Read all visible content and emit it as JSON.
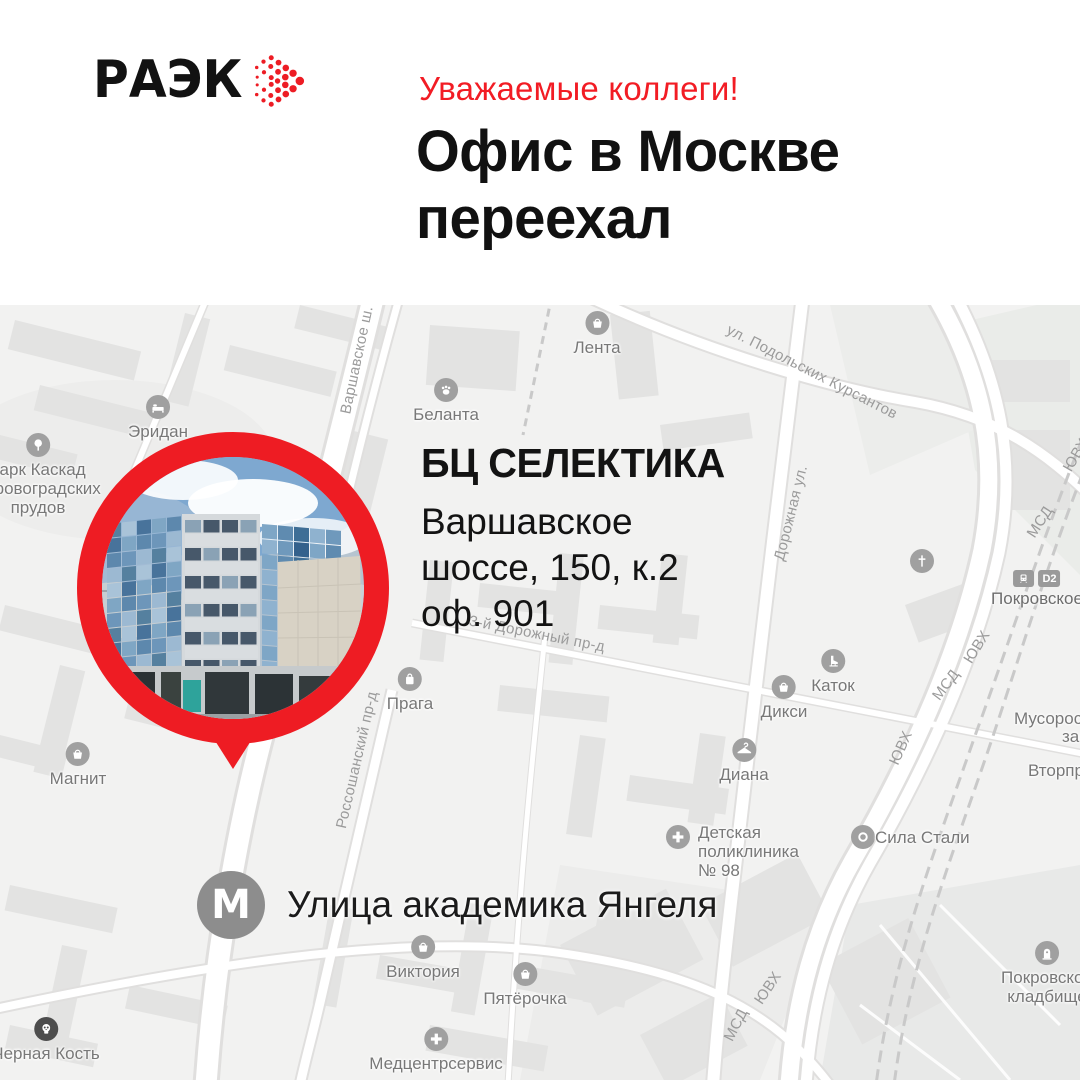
{
  "header": {
    "logo": "РАЭК",
    "greeting": "Уважаемые коллеги!",
    "title_line1": "Офис в Москве",
    "title_line2": "переехал"
  },
  "callout": {
    "name": "БЦ СЕЛЕКТИКА",
    "address_lines": [
      "Варшавское",
      "шоссе, 150, к.2",
      "оф. 901"
    ]
  },
  "metro": {
    "symbol": "М",
    "station": "Улица академика Янгеля"
  },
  "map": {
    "pois": [
      {
        "name": "lenta",
        "icon": "basket",
        "layout": "below",
        "x": 597,
        "y": 6,
        "lines": [
          "Лента"
        ]
      },
      {
        "name": "belanta",
        "icon": "paw",
        "layout": "below",
        "x": 446,
        "y": 73,
        "lines": [
          "Беланта"
        ]
      },
      {
        "name": "eridan",
        "icon": "bed",
        "layout": "below",
        "x": 158,
        "y": 90,
        "lines": [
          "Эридан"
        ]
      },
      {
        "name": "park-kaskad",
        "icon": "tree",
        "layout": "below",
        "x": 38,
        "y": 128,
        "lines": [
          "парк Каскад",
          "Кировоградских",
          "прудов"
        ]
      },
      {
        "name": "magnit",
        "icon": "basket",
        "layout": "below",
        "x": 78,
        "y": 437,
        "lines": [
          "Магнит"
        ]
      },
      {
        "name": "praga",
        "icon": "bag",
        "layout": "below",
        "x": 410,
        "y": 362,
        "lines": [
          "Прага"
        ]
      },
      {
        "name": "katok",
        "icon": "skate",
        "layout": "below",
        "x": 833,
        "y": 344,
        "lines": [
          "Каток"
        ]
      },
      {
        "name": "diksi",
        "icon": "basket",
        "layout": "below",
        "x": 784,
        "y": 370,
        "lines": [
          "Дикси"
        ]
      },
      {
        "name": "diana",
        "icon": "hanger",
        "layout": "below",
        "x": 744,
        "y": 433,
        "lines": [
          "Диана"
        ]
      },
      {
        "name": "detskaya-poliklinika",
        "icon": "med",
        "layout": "left-icon",
        "x": 666,
        "y": 518,
        "lines": [
          "Детская",
          "поликлиника",
          "№ 98"
        ]
      },
      {
        "name": "sila-stali",
        "icon": "ring",
        "layout": "right-icon",
        "x": 843,
        "y": 520,
        "lines": [
          "Сила Стали"
        ]
      },
      {
        "name": "chernaya-kost",
        "icon": "skull",
        "dark": true,
        "layout": "below",
        "x": 46,
        "y": 712,
        "lines": [
          "Черная Кость"
        ]
      },
      {
        "name": "viktoriya",
        "icon": "basket",
        "layout": "below",
        "x": 423,
        "y": 630,
        "lines": [
          "Виктория"
        ]
      },
      {
        "name": "pyaterochka",
        "icon": "basket",
        "layout": "below",
        "x": 525,
        "y": 657,
        "lines": [
          "Пятёрочка"
        ]
      },
      {
        "name": "medcentrservis",
        "icon": "med",
        "layout": "below",
        "x": 436,
        "y": 722,
        "lines": [
          "Медцентрсервис"
        ]
      },
      {
        "name": "pokrovskoe-kladbishche",
        "icon": "tomb",
        "layout": "below",
        "x": 1047,
        "y": 636,
        "lines": [
          "Покровское",
          "кладбище"
        ]
      },
      {
        "name": "church",
        "icon": "cross",
        "layout": "icon-only",
        "x": 922,
        "y": 244,
        "lines": []
      },
      {
        "name": "musoro-line1",
        "icon": "none",
        "layout": "plain",
        "x": 1014,
        "y": 404,
        "lines": [
          "Мусоросжигательный"
        ]
      },
      {
        "name": "musoro-line2",
        "icon": "none",
        "layout": "plain",
        "x": 1062,
        "y": 422,
        "lines": [
          "завод"
        ]
      },
      {
        "name": "vtorprom",
        "icon": "none",
        "layout": "plain",
        "x": 1028,
        "y": 456,
        "lines": [
          "Вторпром"
        ]
      }
    ],
    "road_labels": [
      {
        "text": "Варшавское ш.",
        "x": 357,
        "y": 55,
        "angle": -78
      },
      {
        "text": "ул. Подольских Курсантов",
        "x": 812,
        "y": 67,
        "angle": 27
      },
      {
        "text": "Дорожная ул.",
        "x": 791,
        "y": 208,
        "angle": -76
      },
      {
        "text": "3-й Дорожный пр-д",
        "x": 537,
        "y": 329,
        "angle": 11
      },
      {
        "text": "Россошанский пр-д",
        "x": 357,
        "y": 455,
        "angle": -77
      },
      {
        "text": "ЮВХ",
        "x": 1076,
        "y": 150,
        "angle": -60
      },
      {
        "text": "МСД",
        "x": 1040,
        "y": 217,
        "angle": -57
      },
      {
        "text": "ЮВХ",
        "x": 977,
        "y": 342,
        "angle": -58
      },
      {
        "text": "МСД",
        "x": 946,
        "y": 380,
        "angle": -53
      },
      {
        "text": "ЮВХ",
        "x": 901,
        "y": 443,
        "angle": -66
      },
      {
        "text": "ЮВХ",
        "x": 768,
        "y": 683,
        "angle": -56
      },
      {
        "text": "МСД",
        "x": 736,
        "y": 720,
        "angle": -63
      }
    ],
    "station": {
      "name": "Покровское",
      "badge": "D2",
      "x": 1037,
      "y": 265
    }
  },
  "colors": {
    "accent_red": "#ee1c23",
    "text_black": "#131313",
    "map_background": "#f2f2f1",
    "map_label_gray": "#787878",
    "metro_gray": "#8d8d8d"
  }
}
